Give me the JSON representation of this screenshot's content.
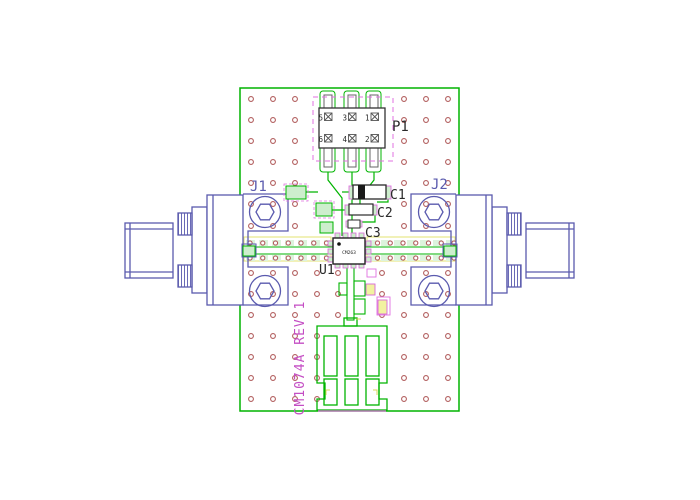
{
  "board": {
    "silkscreen": "CM1074A REV 1",
    "connector_left_ref": "J1",
    "connector_right_ref": "J2",
    "header_ref": "P1",
    "header_pins": [
      "5",
      "3",
      "1",
      "6",
      "4",
      "2"
    ],
    "cap1_ref": "C1",
    "cap2_ref": "C2",
    "cap3_ref": "C3",
    "ic_ref": "U1",
    "ic_marking": "CM263"
  },
  "colors": {
    "board_outline_green": "#00b400",
    "pad_fill_green": "#cdeecd",
    "keepout_yellow": "#e3e370",
    "via_ring_red": "#b25e5e",
    "connector_blue": "#5a5aae",
    "component_outline_black": "#2a2a2a",
    "pad_outline_magenta": "#e070e0",
    "silkscreen_magenta": "#c44ec4"
  }
}
